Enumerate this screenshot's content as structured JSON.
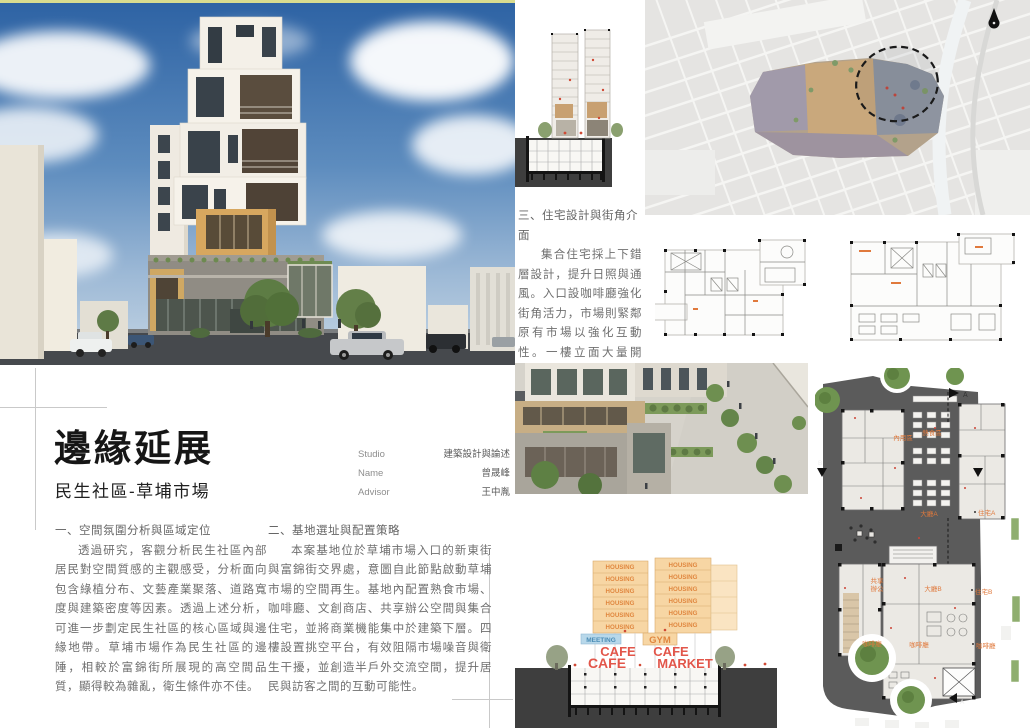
{
  "title_block": {
    "title": "邊緣延展",
    "subtitle": "民生社區-草埔市場"
  },
  "credits": {
    "rows": [
      {
        "label": "Studio",
        "value": "建築設計與論述"
      },
      {
        "label": "Name",
        "value": "曾晟峰"
      },
      {
        "label": "Advisor",
        "value": "王中胤"
      }
    ]
  },
  "sections": {
    "one": {
      "heading": "一、空間氛圍分析與區域定位",
      "body": "透過研究，客觀分析民生社區內部居民對空間質感的主觀感受，分析面向包含綠植分布、文藝產業聚落、道路寬度與建築密度等因素。透過上述分析，可進一步劃定民生社區的核心區域與邊緣地帶。草埔市場作為民生社區的邊陲，相較於富錦街所展現的高空間品質，顯得較為雜亂，衛生條件亦不佳。"
    },
    "two": {
      "heading": "二、基地選址與配置策略",
      "body": "本案基地位於草埔市場入口的新東街與富錦街交界處，意圖自此節點啟動草埔市場的空間再生。基地內配置熟食市場、咖啡廳、文創商店、共享辦公空間與集合住宅，並將商業機能集中於建築下層。四樓設置挑空平台，有效阻隔市場噪音與衛生干擾，並創造半戶外交流空間，提升居民與訪客之間的互動可能性。"
    },
    "three": {
      "heading": "三、住宅設計與街角介面",
      "body": "集合住宅採上下錯層設計，提升日照與通風。入口設咖啡廳強化街角活力，市場則緊鄰原有市場以強化互動性。一樓立面大量開口，提升可達性與開放性，使建築成為連結社區與市場的界面節點角色。"
    }
  },
  "program_section": {
    "housing": "HOUSING",
    "meeting": "MEETING",
    "gym": "GYM",
    "cafe": "CAFE",
    "market": "MARKET"
  },
  "site_plan": {
    "labels": {
      "dine_area": "內用區",
      "hot_food": "熱食區",
      "lobby_a": "大廳A",
      "housing_a": "住宅A",
      "coworking_1": "共享",
      "coworking_2": "辦公",
      "lobby_b": "大廳B",
      "housing_b": "住宅B",
      "cafe_left": "咖啡廳",
      "cafe_center": "咖啡廳",
      "cafe_right": "咖啡廳"
    },
    "section_marks": {
      "a": "A",
      "b": "B"
    }
  },
  "colors": {
    "topline_yellow": "#d9dc8f",
    "accent_orange": "#e0873f",
    "label_red": "#e2564a",
    "label_blue": "#4a8cb5",
    "poche_dark": "#3e3e3e",
    "siteplan_gray": "#5b5b5b",
    "district_tan": "#c9a87c"
  }
}
